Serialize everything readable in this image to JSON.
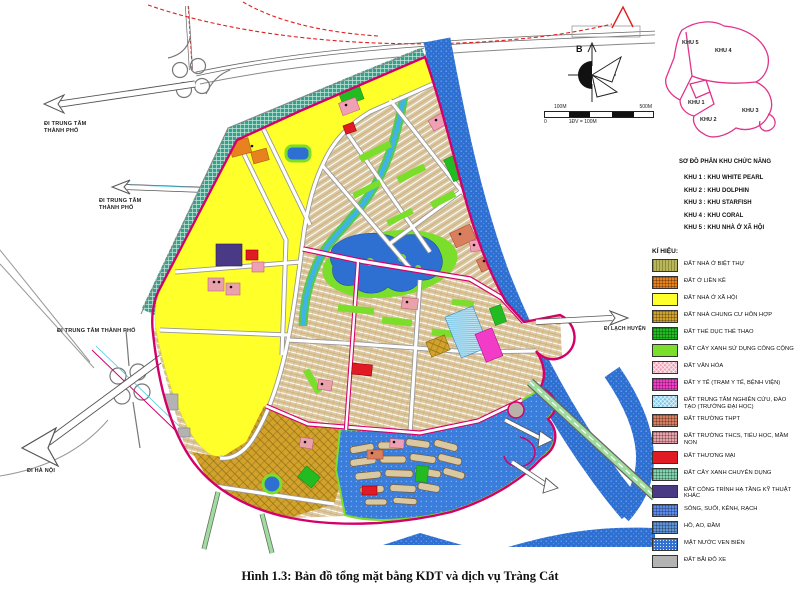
{
  "caption": "Hình 1.3: Bản đồ tổng mặt bằng KDT và dịch vụ Tràng Cát",
  "compass": {
    "north_label": "B"
  },
  "scale_bar": {
    "left_tick": "100M",
    "right_tick": "500M",
    "zero": "0",
    "note": "1ĐV = 100M"
  },
  "map": {
    "labels": {
      "city1_line1": "ĐI TRUNG TÂM",
      "city1_line2": "THÀNH PHỐ",
      "city2_line1": "ĐI TRUNG TÂM",
      "city2_line2": "THÀNH PHỐ",
      "city3": "ĐI TRUNG TÂM THÀNH PHỐ",
      "hanoi": "ĐI HÀ NỘI",
      "lach_huyen": "ĐI LẠCH HUYỆN"
    }
  },
  "inset": {
    "title": "SƠ ĐỒ PHÂN KHU CHỨC NĂNG",
    "zone_labels": [
      "KHU 1",
      "KHU 2",
      "KHU 3",
      "KHU 4",
      "KHU 5"
    ],
    "zone_list": [
      {
        "text": "KHU 1 : KHU WHITE PEARL"
      },
      {
        "text": "KHU 2 : KHU DOLPHIN"
      },
      {
        "text": "KHU 3 : KHU STARFISH"
      },
      {
        "text": "KHU 4 : KHU CORAL"
      },
      {
        "text": "KHU 5 : KHU NHÀ Ở XÃ HỘI"
      }
    ]
  },
  "legend": {
    "title": "KÍ HIỆU:",
    "items": [
      {
        "label": "ĐẤT NHÀ Ở BIỆT THỰ",
        "color": "#b8b55a",
        "pattern": "vhatch"
      },
      {
        "label": "ĐẤT Ở LIỀN KỀ",
        "color": "#e8821e",
        "pattern": "grid"
      },
      {
        "label": "ĐẤT NHÀ Ở XÃ HỘI",
        "color": "#ffff2a",
        "pattern": "solid"
      },
      {
        "label": "ĐẤT NHÀ CHUNG CƯ HỖN HỢP",
        "color": "#d2a22c",
        "pattern": "grid"
      },
      {
        "label": "ĐẤT THỂ DỤC THỂ THAO",
        "color": "#22bb22",
        "pattern": "grid"
      },
      {
        "label": "ĐẤT CÂY XANH SỬ DỤNG CÔNG CỘNG",
        "color": "#7ade2b",
        "pattern": "solid"
      },
      {
        "label": "ĐẤT VĂN HÓA",
        "color": "#f0a0b4",
        "pattern": "diag"
      },
      {
        "label": "ĐẤT Y TẾ (TRẠM Y TẾ, BỆNH VIỆN)",
        "color": "#f23cc8",
        "pattern": "grid"
      },
      {
        "label": "ĐẤT TRUNG TÂM NGHIÊN CỨU, ĐÀO TẠO (TRƯỜNG ĐẠI HỌC)",
        "color": "#7cc8e8",
        "pattern": "diag"
      },
      {
        "label": "ĐẤT TRƯỜNG THPT",
        "color": "#d97f5f",
        "pattern": "grid"
      },
      {
        "label": "ĐẤT TRƯỜNG THCS, TIỂU HỌC, MẦM NON",
        "color": "#eaa2aa",
        "pattern": "grid"
      },
      {
        "label": "ĐẤT THƯƠNG MẠI",
        "color": "#e01b24",
        "pattern": "solid"
      },
      {
        "label": "ĐẤT CÂY XANH CHUYÊN DỤNG",
        "color": "#7fd4ae",
        "pattern": "grid"
      },
      {
        "label": "ĐẤT CÔNG TRÌNH HẠ TẦNG KỸ THUẬT KHÁC",
        "color": "#4a3a85",
        "pattern": "solid"
      },
      {
        "label": "SÔNG, SUỐI, KÊNH, RẠCH",
        "color": "#5b8bec",
        "pattern": "grid"
      },
      {
        "label": "HỒ, AO, ĐẦM",
        "color": "#5e93d6",
        "pattern": "grid"
      },
      {
        "label": "MẶT NƯỚC VEN BIỂN",
        "color": "#2e6fd2",
        "pattern": "dots"
      },
      {
        "label": "ĐẤT BÃI ĐỖ XE",
        "color": "#b3b3b3",
        "pattern": "solid"
      }
    ]
  },
  "colors": {
    "district_boundary": "#d4006a",
    "river_water": "#2e70d2",
    "green_belt": "#35a08c",
    "residential_base": "#d9c8a2",
    "social_housing": "#ffff2a"
  }
}
